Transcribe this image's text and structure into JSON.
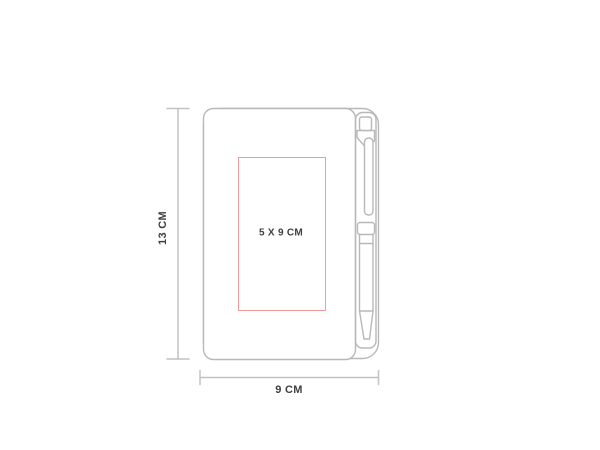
{
  "diagram": {
    "subject": "notebook-with-pen",
    "labels": {
      "height": "13 CM",
      "width": "9 CM",
      "print_area": "5 X 9 CM"
    },
    "colors": {
      "background": "#ffffff",
      "outline_gray": "#b8b8b8",
      "dimension_gray": "#c2c2c2",
      "print_area_red": "#f09a9a",
      "label_text": "#3f3f3f"
    }
  }
}
